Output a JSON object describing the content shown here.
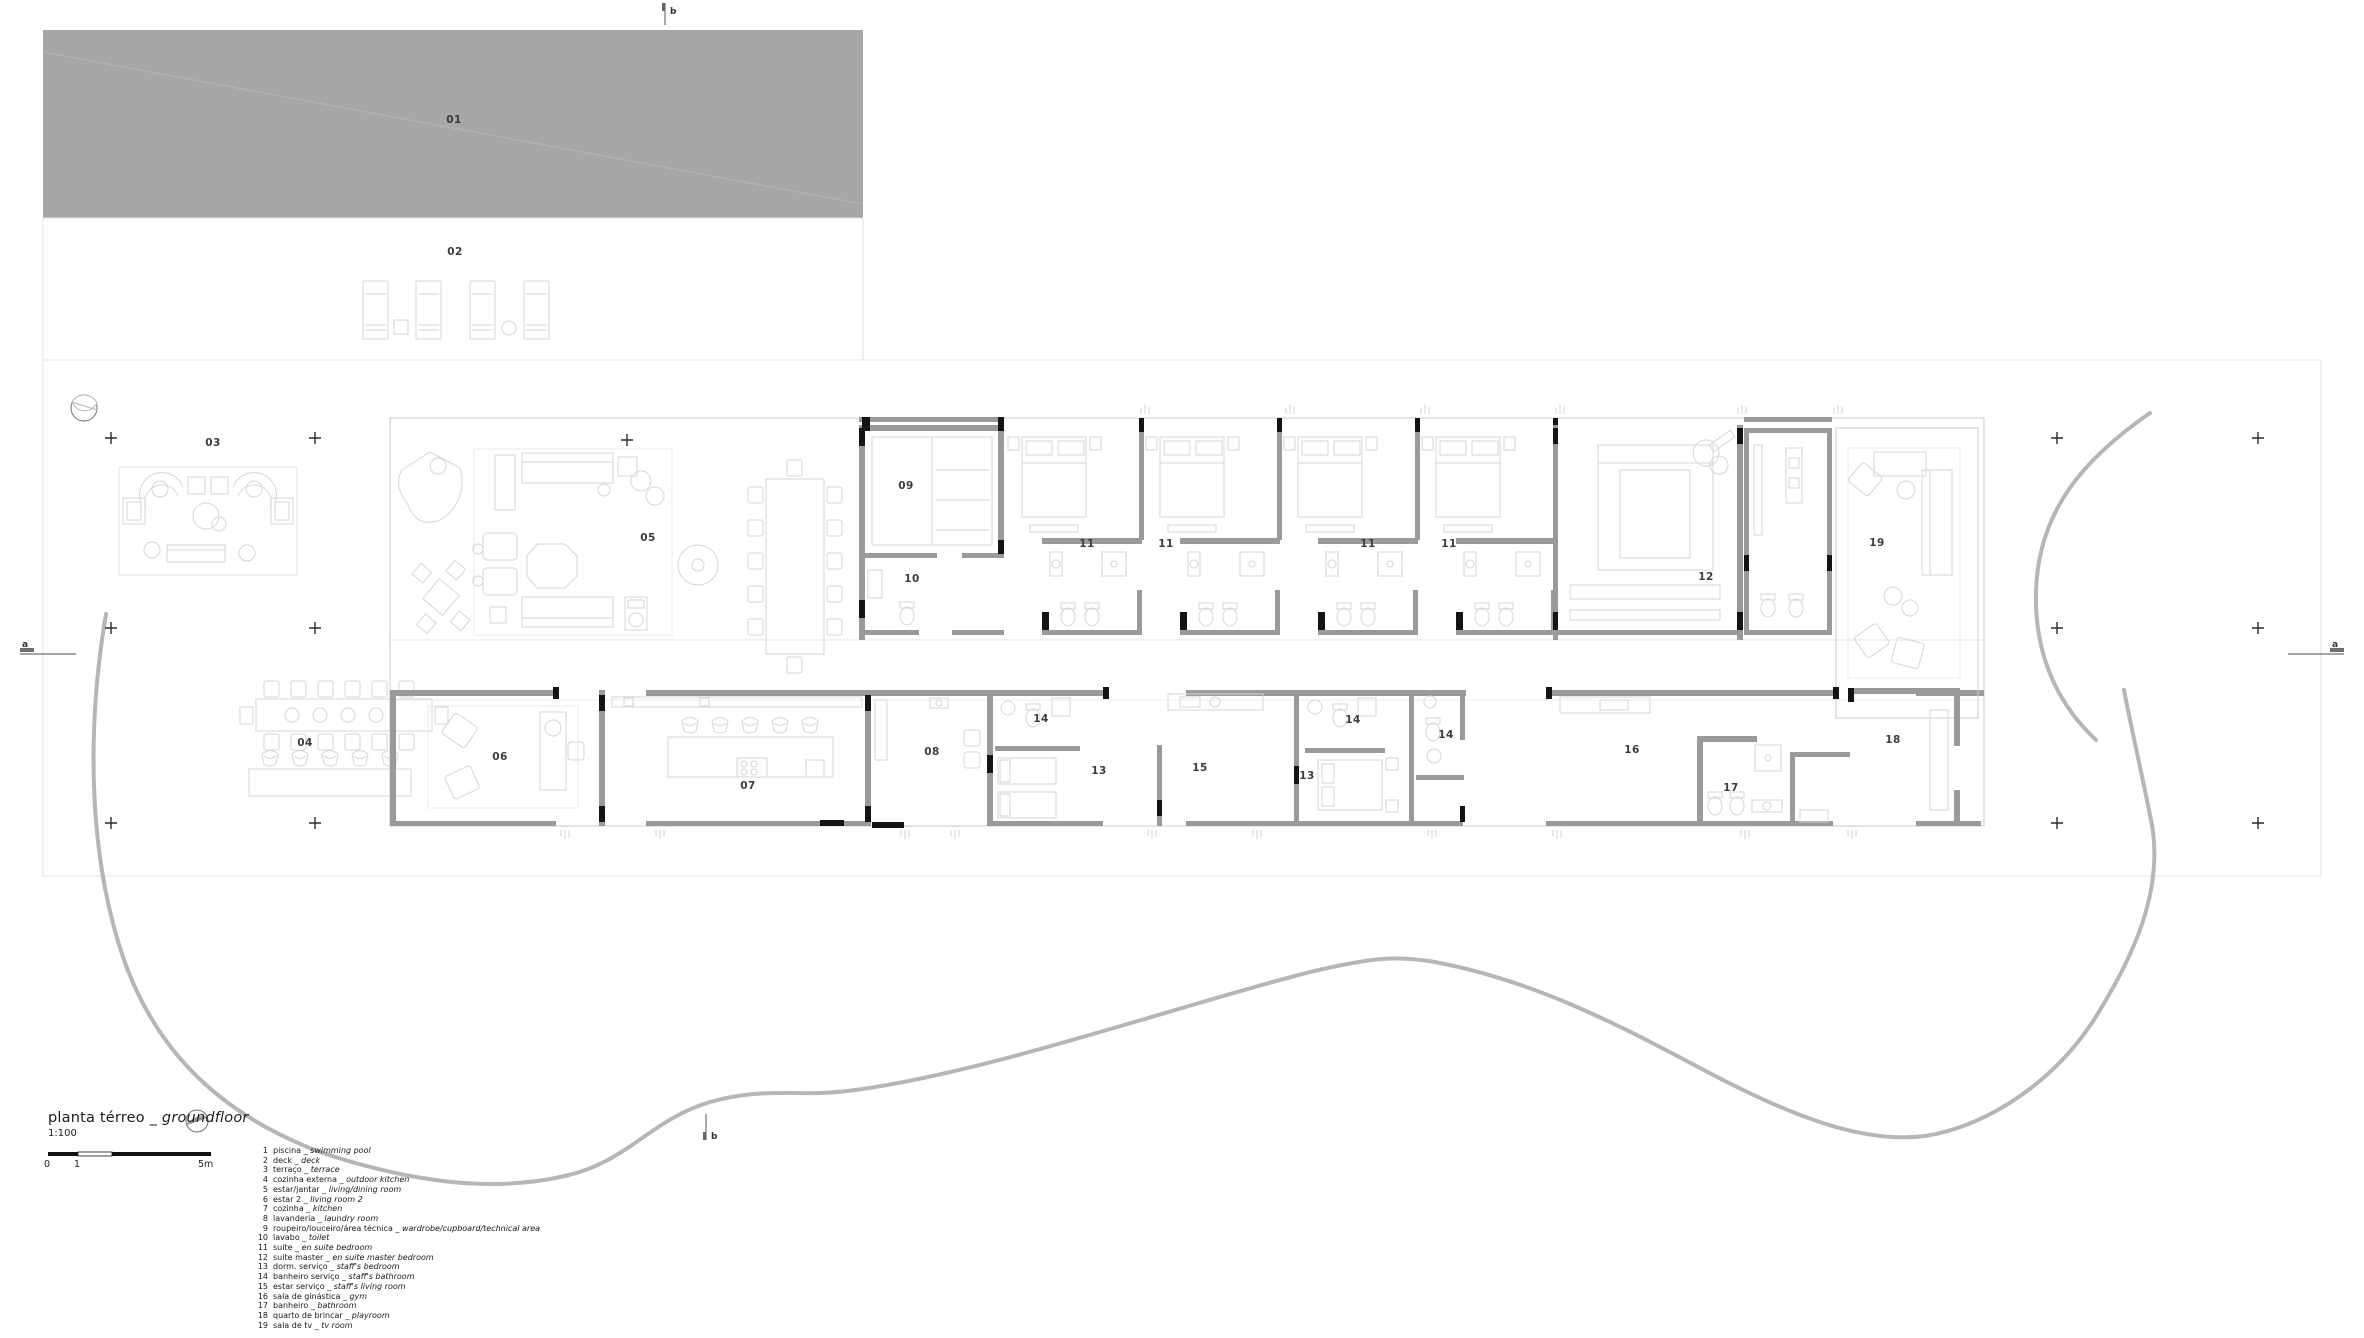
{
  "document": {
    "kind": "architectural ground floor plan"
  },
  "title": {
    "pt": "planta térreo",
    "separator": " _ ",
    "en": "groundfloor",
    "scale": "1:100"
  },
  "scale_bar": {
    "ticks": [
      "0",
      "1",
      "5m"
    ]
  },
  "section_markers": {
    "top": "b",
    "bottom": "b",
    "left": "a",
    "right": "a"
  },
  "legend": [
    {
      "num": "1",
      "pt": "piscina",
      "en": "swimming pool"
    },
    {
      "num": "2",
      "pt": "deck",
      "en": "deck"
    },
    {
      "num": "3",
      "pt": "terraço",
      "en": "terrace"
    },
    {
      "num": "4",
      "pt": "cozinha externa",
      "en": "outdoor kitchen"
    },
    {
      "num": "5",
      "pt": "estar/jantar",
      "en": "living/dining room"
    },
    {
      "num": "6",
      "pt": "estar 2",
      "en": "living room 2"
    },
    {
      "num": "7",
      "pt": "cozinha",
      "en": "kitchen"
    },
    {
      "num": "8",
      "pt": "lavanderia",
      "en": "laundry room"
    },
    {
      "num": "9",
      "pt": "roupeiro/louceiro/área técnica",
      "en": "wardrobe/cupboard/technical area"
    },
    {
      "num": "10",
      "pt": "lavabo",
      "en": "toilet"
    },
    {
      "num": "11",
      "pt": "suite",
      "en": "en suite bedroom"
    },
    {
      "num": "12",
      "pt": "suite master",
      "en": "en suite master bedroom"
    },
    {
      "num": "13",
      "pt": "dorm. serviço",
      "en": "staff's bedroom"
    },
    {
      "num": "14",
      "pt": "banheiro serviço",
      "en": "staff's bathroom"
    },
    {
      "num": "15",
      "pt": "estar serviço",
      "en": "staff's living room"
    },
    {
      "num": "16",
      "pt": "sala de ginástica",
      "en": "gym"
    },
    {
      "num": "17",
      "pt": "banheiro",
      "en": "bathroom"
    },
    {
      "num": "18",
      "pt": "quarto de brincar",
      "en": "playroom"
    },
    {
      "num": "19",
      "pt": "sala de tv",
      "en": "tv room"
    }
  ],
  "rooms": [
    {
      "n": "01",
      "x": 454,
      "y": 123
    },
    {
      "n": "02",
      "x": 455,
      "y": 255
    },
    {
      "n": "03",
      "x": 213,
      "y": 446
    },
    {
      "n": "04",
      "x": 305,
      "y": 746
    },
    {
      "n": "05",
      "x": 648,
      "y": 541
    },
    {
      "n": "06",
      "x": 500,
      "y": 760
    },
    {
      "n": "07",
      "x": 748,
      "y": 789
    },
    {
      "n": "08",
      "x": 932,
      "y": 755
    },
    {
      "n": "09",
      "x": 906,
      "y": 489
    },
    {
      "n": "10",
      "x": 912,
      "y": 582
    },
    {
      "n": "11",
      "x": 1087,
      "y": 547
    },
    {
      "n": "11",
      "x": 1166,
      "y": 547
    },
    {
      "n": "11",
      "x": 1368,
      "y": 547
    },
    {
      "n": "11",
      "x": 1449,
      "y": 547
    },
    {
      "n": "12",
      "x": 1706,
      "y": 580
    },
    {
      "n": "13",
      "x": 1099,
      "y": 774
    },
    {
      "n": "13",
      "x": 1307,
      "y": 779
    },
    {
      "n": "14",
      "x": 1041,
      "y": 722
    },
    {
      "n": "14",
      "x": 1353,
      "y": 723
    },
    {
      "n": "14",
      "x": 1446,
      "y": 738
    },
    {
      "n": "15",
      "x": 1200,
      "y": 771
    },
    {
      "n": "16",
      "x": 1632,
      "y": 753
    },
    {
      "n": "17",
      "x": 1731,
      "y": 791
    },
    {
      "n": "18",
      "x": 1893,
      "y": 743
    },
    {
      "n": "19",
      "x": 1877,
      "y": 546
    }
  ],
  "colors": {
    "pool_fill": "#a7a7a7",
    "wall_gray": "#9a9a9a",
    "column_black": "#141414",
    "faint_line": "#e3e3e3",
    "furniture_line": "#d6d6d6",
    "driveway_line": "#b6b6b6",
    "text": "#333333"
  }
}
